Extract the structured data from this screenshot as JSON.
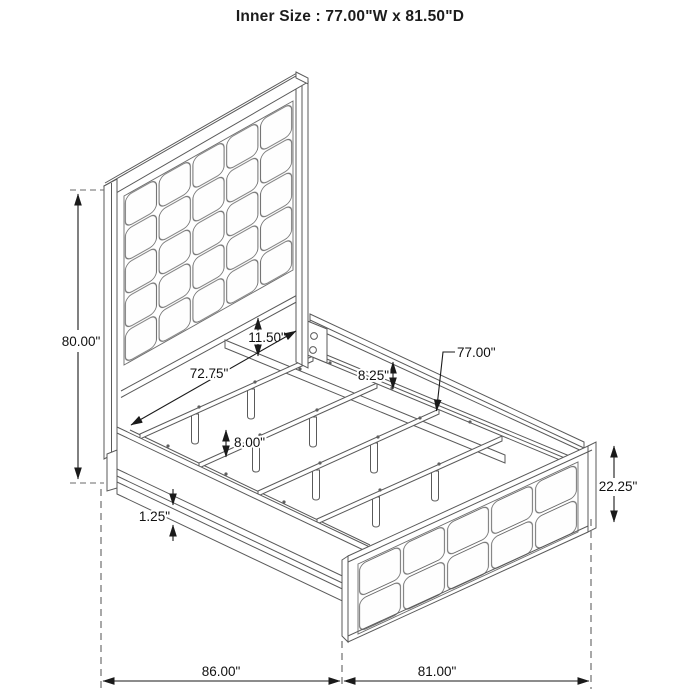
{
  "title": "Inner Size : 77.00\"W x 81.50\"D",
  "annotations": {
    "headboard_height": "80.00\"",
    "headboard_gap": "11.50\"",
    "side_rail_span": "72.75\"",
    "side_rail_height": "8.25\"",
    "slat_length": "77.00\"",
    "support_leg_height": "8.00\"",
    "rail_lip_thickness": "1.25\"",
    "footboard_height": "22.25\"",
    "overall_length": "86.00\"",
    "overall_width": "81.00\""
  }
}
